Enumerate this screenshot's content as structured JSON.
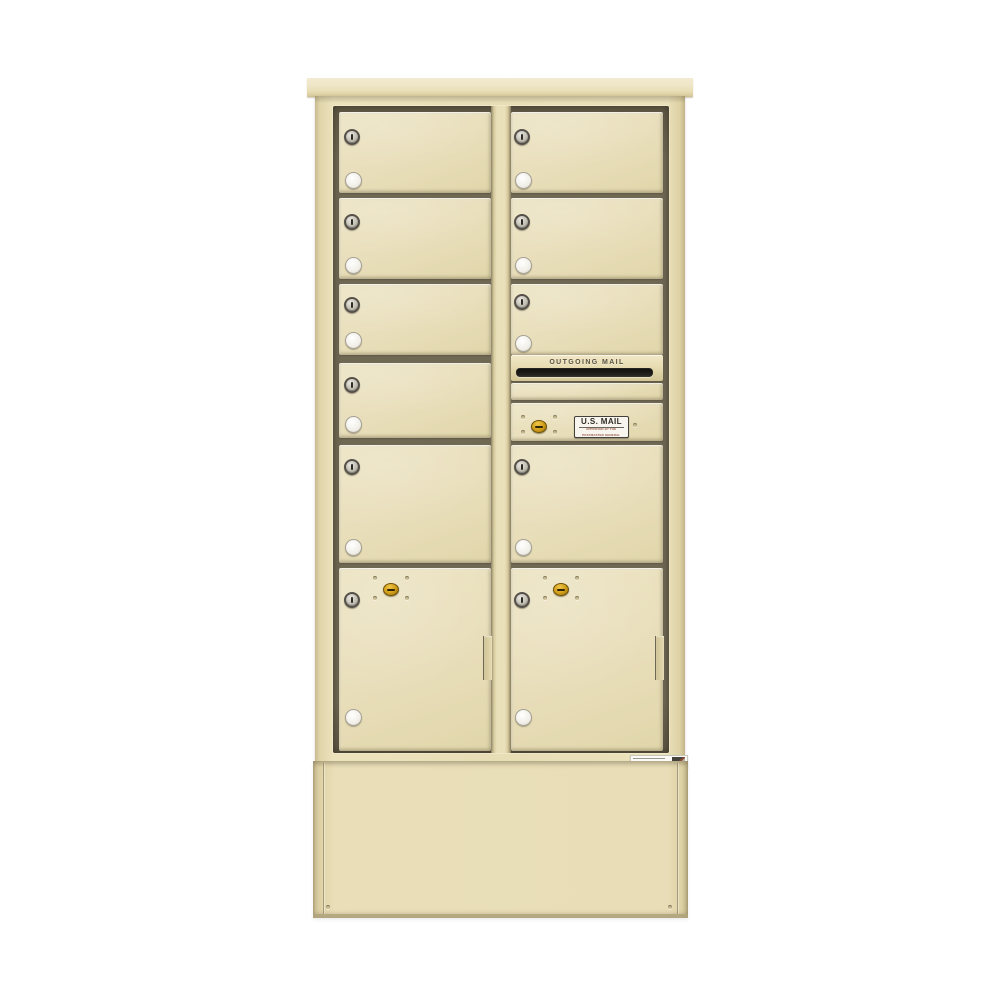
{
  "scene": {
    "subject": "Free-standing two-column 4C depot mailbox cabinet on matching pedestal, beige sandstone finish, front view",
    "background": "#ffffff"
  },
  "labels": {
    "outgoing_mail": "OUTGOING MAIL",
    "us_mail_title": "U.S. MAIL",
    "us_mail_sub1": "APPROVED BY THE",
    "us_mail_sub2": "POSTMASTER GENERAL"
  },
  "counts": {
    "door_columns": 2,
    "tenant_doors": 9,
    "parcel_lockers": 2,
    "master_access_doors": 1,
    "outgoing_mail_slots": 1,
    "tenant_door_locks": 9,
    "door_number_discs": 9,
    "brass_locks": 3
  },
  "colors": {
    "body_sand": "#e8ddb5",
    "door_face": "#e9dfbc",
    "cap_top": "#f2ead0",
    "well_shadow": "#6f6853",
    "pedestal": "#e8ddb6",
    "lock_silver": "#c2bfb4",
    "lock_ring": "#55514a",
    "number_disc": "#f4f2ec",
    "brass": "#cf9c18",
    "mail_slot": "#14130f",
    "decal_background": "#f7f5ee",
    "decal_text": "#2e2c26",
    "decal_subtext": "#9c5a48"
  }
}
